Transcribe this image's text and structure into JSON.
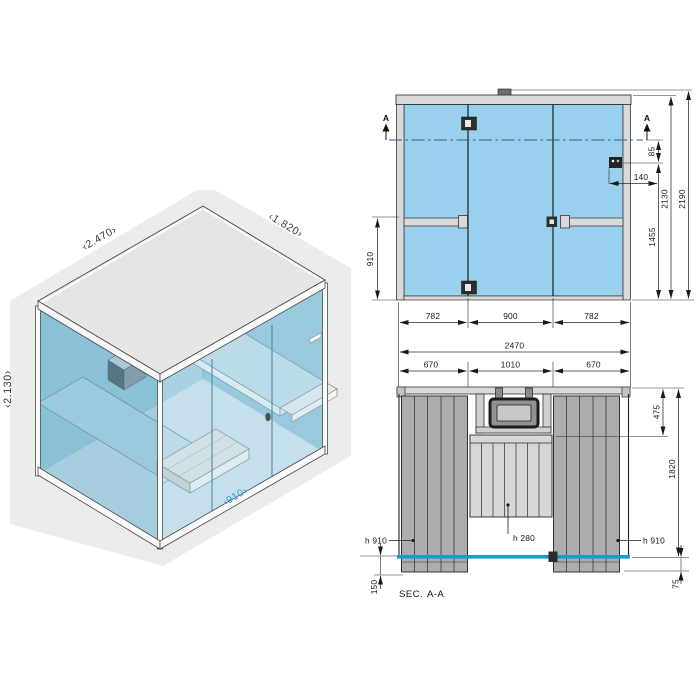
{
  "title": "glass cabin technical drawing",
  "colors": {
    "glass_blue": "#99d0ed",
    "glass_front_line": "#1b9ad2",
    "iso_label_blue": "#2d9fd6",
    "frame_gray": "#d8d9da",
    "bench_gray": "#abadae"
  },
  "iso": {
    "width": "‹2.470›",
    "depth": "‹1.820›",
    "height": "‹2.130›",
    "door_width": "‹910›"
  },
  "elev": {
    "a_left": "A",
    "a_right": "A",
    "d85": "85",
    "d140": "140",
    "d2130": "2130",
    "d2190": "2190",
    "d1455": "1455",
    "d910": "910",
    "d782a": "782",
    "d900": "900",
    "d782b": "782",
    "d2470": "2470"
  },
  "plan": {
    "d670a": "670",
    "d1010": "1010",
    "d670b": "670",
    "d475": "475",
    "d1820": "1820",
    "d75": "75",
    "d150": "150",
    "h910_left": "h 910",
    "h280": "h 280",
    "h910_right": "h 910",
    "sec": "SEC.",
    "sec_name": "A-A"
  }
}
